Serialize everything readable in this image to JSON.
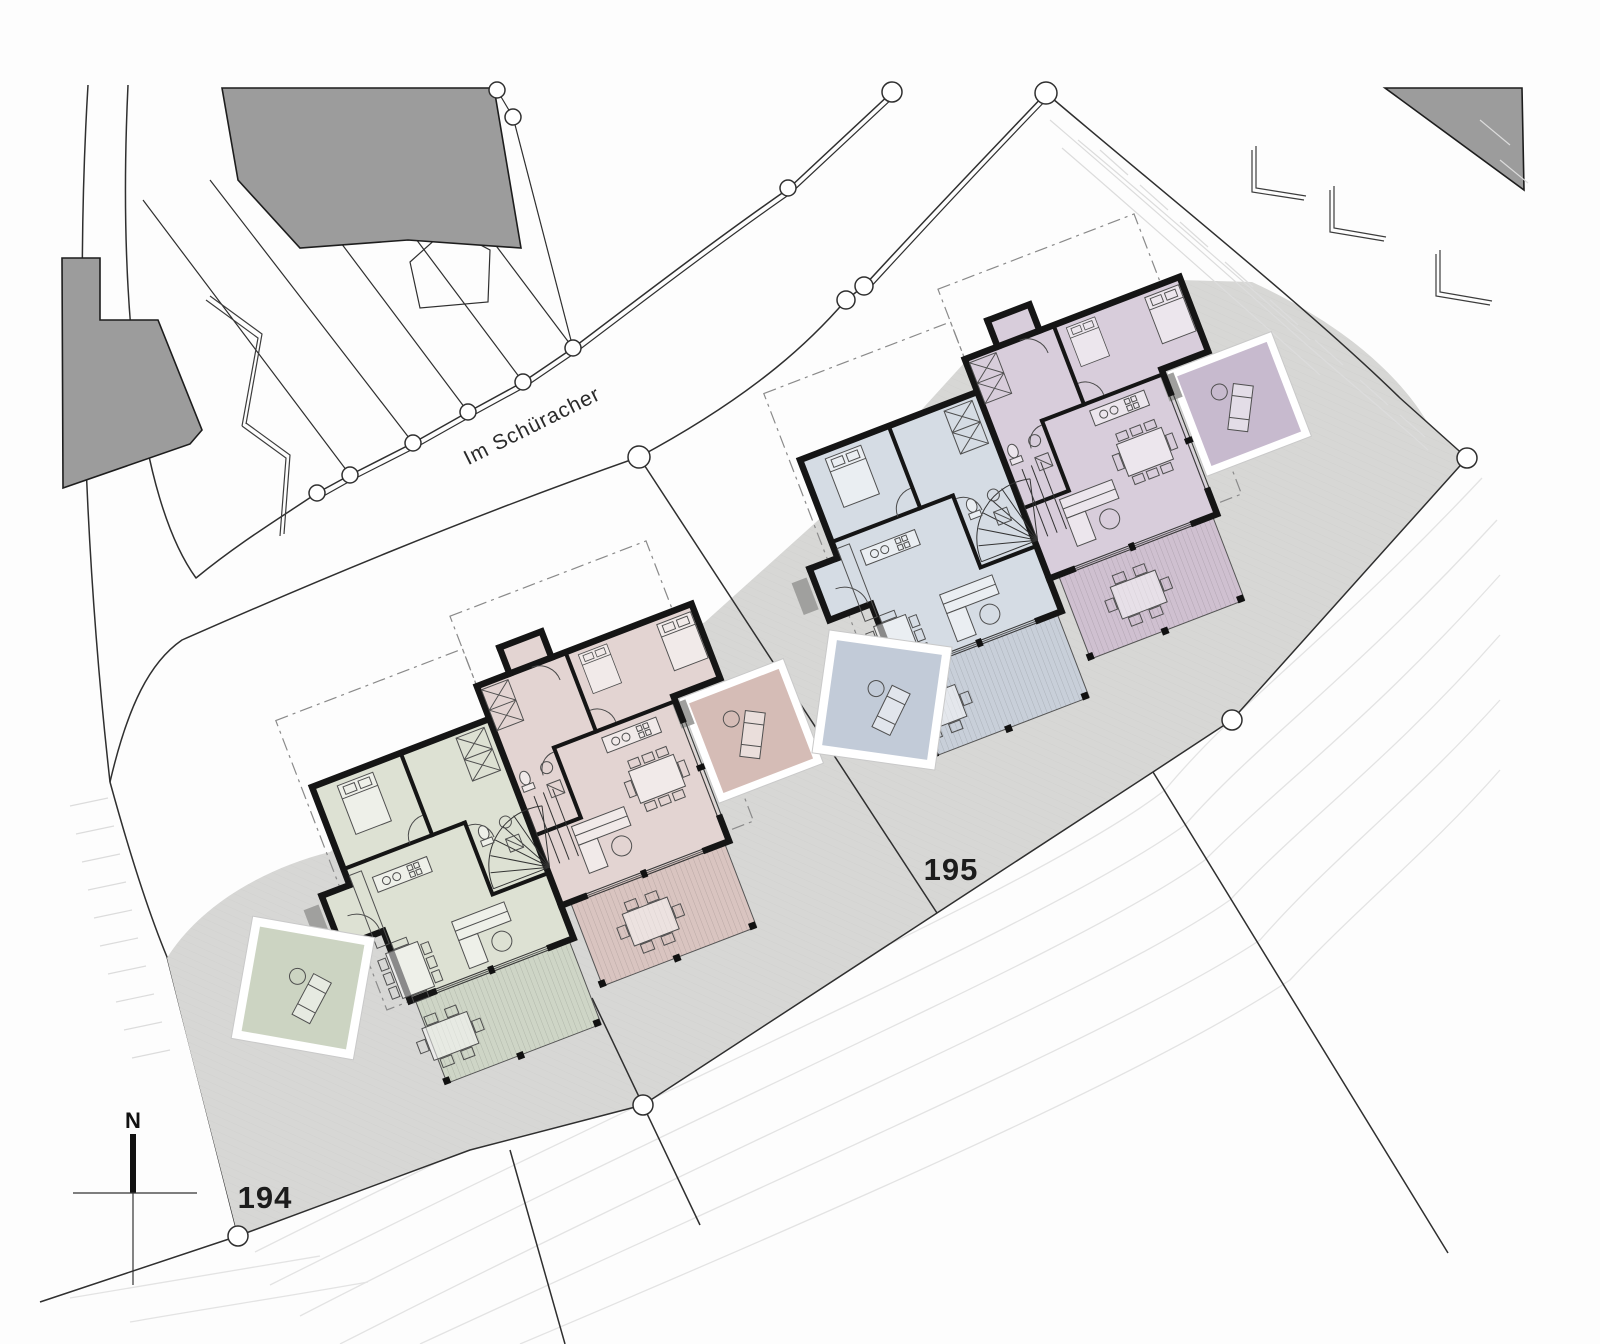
{
  "labels": {
    "street": "Im Schüracher",
    "parcel_left": "194",
    "parcel_right": "195",
    "north": "N"
  },
  "colors": {
    "site_gray": "#d7d7d5",
    "existing_gray": "#9c9c9c",
    "line_dark": "#2f2f2f",
    "wall_black": "#151515",
    "contour": "#e3e3e3",
    "hatch_tick": "#dcdcdc",
    "furniture": "#4f4f4f",
    "unit_green": "#dde1d3",
    "unit_rose": "#e3d4d2",
    "deck_green": "#ced5c6",
    "deck_rose": "#d9c4c0",
    "patio_green": "#ccd4c2",
    "patio_rose": "#d5bcb6",
    "unit_blue": "#d5dce4",
    "unit_mauve": "#d8cddb",
    "deck_blue": "#c8cfd9",
    "deck_mauve": "#cfc0d0",
    "patio_blue": "#c2cbd8",
    "patio_mauve": "#c7bace"
  }
}
